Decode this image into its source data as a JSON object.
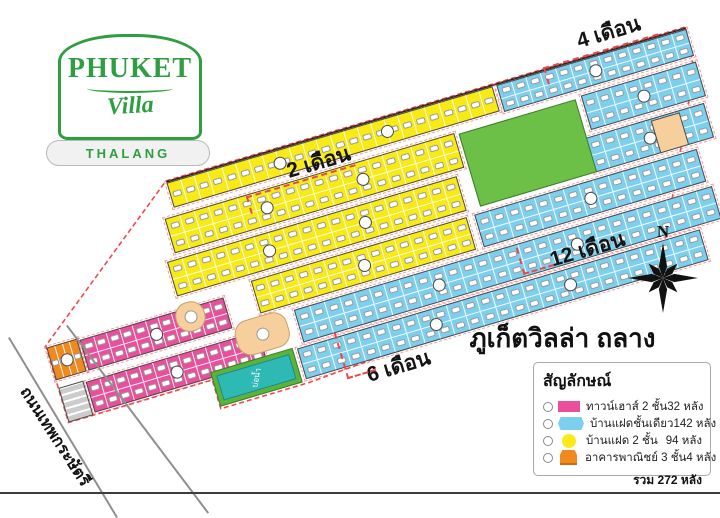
{
  "logo": {
    "brand": "PHUKET",
    "script": "Villa",
    "location": "THALANG"
  },
  "site": {
    "title": "ภูเก็ตวิลล่า ถลาง",
    "road_name": "ถนนเทพกระษัตรี",
    "pond_label": "บ่อน้ำ",
    "compass_label": "N"
  },
  "phases": [
    {
      "label": "4 เดือน"
    },
    {
      "label": "2 เดือน"
    },
    {
      "label": "12 เดือน"
    },
    {
      "label": "6 เดือน"
    }
  ],
  "legend": {
    "title": "สัญลักษณ์",
    "items": [
      {
        "type": "townhouse-2-storey",
        "shape": "rect",
        "color": "#ea4f9b",
        "label": "ทาวน์เฮาส์ 2 ชั้น",
        "count": "32 หลัง"
      },
      {
        "type": "twin-house-1-storey",
        "shape": "hex",
        "color": "#7dcfee",
        "label": "บ้านแฝดชั้นเดียว",
        "count": "142 หลัง"
      },
      {
        "type": "twin-house-2-storey",
        "shape": "circle",
        "color": "#ffe81a",
        "label": "บ้านแฝด 2 ชั้น",
        "count": "94 หลัง"
      },
      {
        "type": "commercial-3-storey",
        "shape": "building",
        "color": "#f08a1f",
        "label": "อาคารพาณิชย์ 3 ชั้น",
        "count": "4 หลัง"
      }
    ],
    "total": "รวม 272 หลัง"
  },
  "colors": {
    "yellow": "#f7ea16",
    "blue": "#7dcfee",
    "pink": "#ea4f9b",
    "orange": "#f08a1f",
    "park_green": "#6cbf47",
    "pond_teal": "#2fb9b4",
    "garden_tan": "#f6cf9c",
    "boundary_red": "#f2484d",
    "logo_green": "#2f9e41"
  },
  "map": {
    "rotation_deg": -16.5,
    "strips": [
      {
        "id": "yellow-top-row",
        "color": "yellow",
        "x": 162,
        "y": 4,
        "w": 340,
        "h": 26,
        "rows": 1,
        "lots": 24
      },
      {
        "id": "blue-top-right",
        "color": "blue",
        "x": 506,
        "y": 4,
        "w": 198,
        "h": 28,
        "rows": 2,
        "lots": 13
      },
      {
        "id": "yellow-row-2",
        "color": "yellow",
        "x": 150,
        "y": 38,
        "w": 302,
        "h": 36,
        "rows": 2,
        "lots": 20
      },
      {
        "id": "blue-row-2-right",
        "color": "blue",
        "x": 584,
        "y": 38,
        "w": 120,
        "h": 36,
        "rows": 2,
        "lots": 8
      },
      {
        "id": "yellow-row-3",
        "color": "yellow",
        "x": 140,
        "y": 80,
        "w": 302,
        "h": 36,
        "rows": 2,
        "lots": 20
      },
      {
        "id": "blue-row-3-right",
        "color": "blue",
        "x": 576,
        "y": 80,
        "w": 124,
        "h": 36,
        "rows": 2,
        "lots": 8
      },
      {
        "id": "yellow-row-4",
        "color": "yellow",
        "x": 215,
        "y": 122,
        "w": 225,
        "h": 34,
        "rows": 2,
        "lots": 15
      },
      {
        "id": "blue-row-4-right",
        "color": "blue",
        "x": 448,
        "y": 122,
        "w": 232,
        "h": 34,
        "rows": 2,
        "lots": 15
      },
      {
        "id": "blue-row-5",
        "color": "blue",
        "x": 248,
        "y": 162,
        "w": 436,
        "h": 34,
        "rows": 2,
        "lots": 28
      },
      {
        "id": "blue-row-6",
        "color": "blue",
        "x": 240,
        "y": 200,
        "w": 420,
        "h": 32,
        "rows": 2,
        "lots": 27
      },
      {
        "id": "pink-row-1",
        "color": "pink",
        "x": 34,
        "y": 130,
        "w": 150,
        "h": 32,
        "rows": 2,
        "lots": 11
      },
      {
        "id": "pink-row-2",
        "color": "pink",
        "x": 28,
        "y": 172,
        "w": 180,
        "h": 32,
        "rows": 2,
        "lots": 13
      },
      {
        "id": "orange-commercial",
        "color": "orange",
        "x": 0,
        "y": 128,
        "w": 32,
        "h": 34,
        "rows": 1,
        "lots": 4
      }
    ],
    "areas": [
      {
        "id": "green-park",
        "type": "park",
        "x": 456,
        "y": 40,
        "w": 122,
        "h": 76
      },
      {
        "id": "pond",
        "type": "pond",
        "x": 150,
        "y": 198,
        "w": 86,
        "h": 36,
        "label": "บ่อน้ำ"
      },
      {
        "id": "garden-1",
        "type": "garden",
        "x": 132,
        "y": 124,
        "w": 30,
        "h": 30
      },
      {
        "id": "garden-2",
        "type": "garden",
        "x": 184,
        "y": 158,
        "w": 54,
        "h": 36
      },
      {
        "id": "corner-lot",
        "type": "tanlot",
        "x": 644,
        "y": 82,
        "w": 30,
        "h": 34
      },
      {
        "id": "facility-1",
        "type": "facility",
        "x": 0,
        "y": 170,
        "w": 26,
        "h": 36
      }
    ],
    "boundary_points": "162,2 704,2 700,46 618,212 242,236 150,236 150,206 0,206 0,126",
    "top_edge": {
      "x1": 162,
      "y1": 3,
      "x2": 704,
      "y2": 3
    }
  }
}
